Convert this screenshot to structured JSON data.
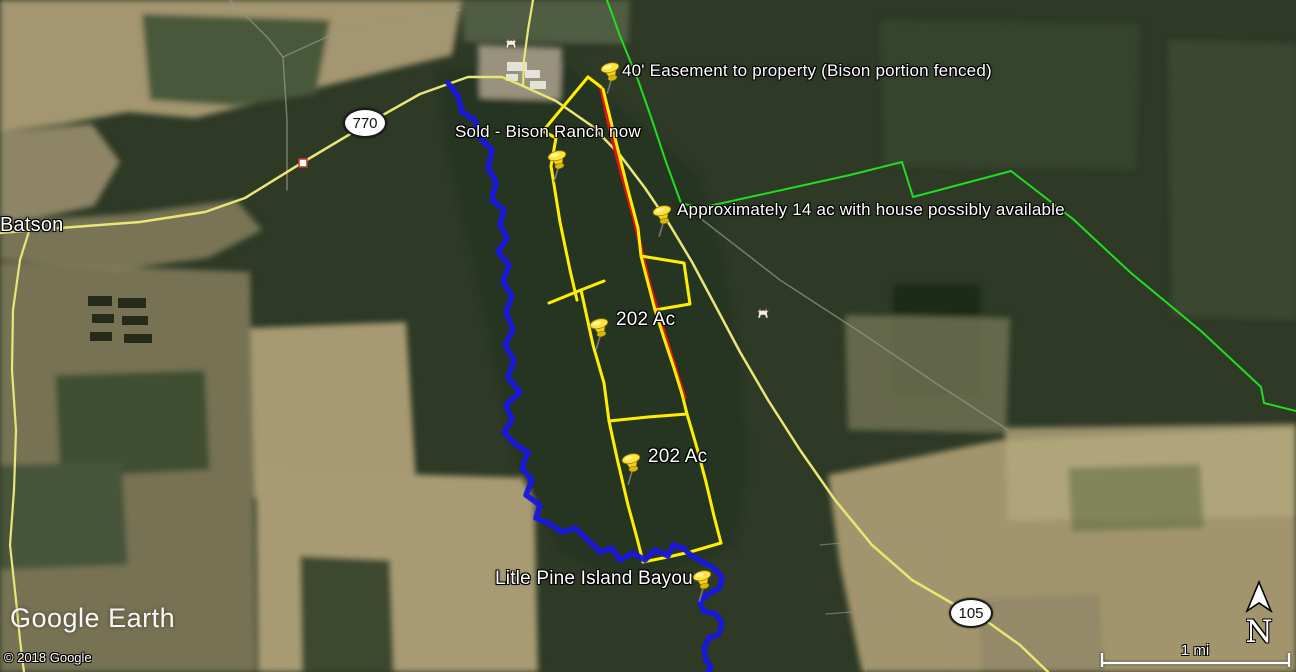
{
  "app": {
    "brand": "Google Earth",
    "copyright": "© 2018 Google",
    "scale_label": "1 mi",
    "compass_label": "N"
  },
  "colors": {
    "property_boundary": "#ffee00",
    "easement": "#e11212",
    "survey_boundary": "#21dd21",
    "bayou": "#1717e0",
    "road": "#e9e678",
    "minor_road": "#949a82",
    "label_text": "#ffffff",
    "shield_bg": "#fdfdfd"
  },
  "placemarks": [
    {
      "id": "batson-town",
      "label": "Batson",
      "label_pos": {
        "x": 0,
        "y": 214
      },
      "size": 20
    },
    {
      "id": "easement",
      "label": "40' Easement to property (Bison portion fenced)",
      "pin": {
        "x": 603,
        "y": 92
      },
      "label_pos": {
        "x": 622,
        "y": 62
      },
      "size": 17
    },
    {
      "id": "sold-bison-ranch",
      "label": "Sold - Bison Ranch now",
      "pin": {
        "x": 550,
        "y": 180
      },
      "label_pos": {
        "x": 455,
        "y": 123
      },
      "size": 17
    },
    {
      "id": "approx-14ac",
      "label": "Approximately 14 ac with house possibly available",
      "pin": {
        "x": 655,
        "y": 235
      },
      "label_pos": {
        "x": 677,
        "y": 201
      },
      "size": 17
    },
    {
      "id": "202ac-north",
      "label": "202 Ac",
      "pin": {
        "x": 592,
        "y": 348
      },
      "label_pos": {
        "x": 616,
        "y": 310
      },
      "size": 19
    },
    {
      "id": "202ac-south",
      "label": "202 Ac",
      "pin": {
        "x": 624,
        "y": 483
      },
      "label_pos": {
        "x": 648,
        "y": 447
      },
      "size": 19
    },
    {
      "id": "bayou-placemark",
      "label": "Litle Pine Island Bayou",
      "pin": {
        "x": 695,
        "y": 600
      },
      "label_pos": {
        "x": 495,
        "y": 569
      },
      "size": 19
    }
  ],
  "road_shields": [
    {
      "text": "770",
      "x": 365,
      "y": 123
    },
    {
      "text": "105",
      "x": 971,
      "y": 613
    }
  ],
  "poi_icons": [
    {
      "type": "animal",
      "x": 511,
      "y": 42
    },
    {
      "type": "animal",
      "x": 763,
      "y": 312
    },
    {
      "type": "box",
      "x": 305,
      "y": 163
    }
  ],
  "map_features": {
    "terrain": [
      {
        "fill": "#a39670",
        "pts": "0,0 462,0 452,55 390,70 325,86 260,102 195,118 128,112 64,124 0,132"
      },
      {
        "fill": "#49593a",
        "pts": "142,14 330,20 316,94 236,106 150,100"
      },
      {
        "fill": "#8d8566",
        "pts": "0,132 92,124 120,162 94,206 38,218 0,222"
      },
      {
        "fill": "#857f5e",
        "pts": "0,222 128,214 236,200 262,230 208,258 118,270 0,260",
        "opacity": 0.85
      },
      {
        "fill": "#a79a72",
        "pts": "250,328 406,322 416,482 348,502 254,498"
      },
      {
        "fill": "#8a8160",
        "pts": "0,262 250,272 256,672 0,672",
        "opacity": 0.8
      },
      {
        "fill": "#415033",
        "pts": "55,375 205,370 210,470 60,478"
      },
      {
        "fill": "#46543a",
        "pts": "0,465 122,462 128,565 0,570"
      },
      {
        "fill": "#a89b73",
        "pts": "256,470 534,478 538,672 258,672"
      },
      {
        "fill": "#3c4a2f",
        "pts": "300,556 390,560 394,672 302,672"
      },
      {
        "fill": "#263420",
        "pts": "438,72 560,60 640,122 700,176 724,260 740,360 748,470 734,546 688,566 624,582 558,552 518,470 494,360 468,240 448,152"
      },
      {
        "fill": "#1e2a17",
        "pts": "893,285 981,285 981,397 893,397"
      },
      {
        "fill": "#3a4830",
        "pts": "880,20 1140,24 1136,170 884,166",
        "opacity": 0.65
      },
      {
        "fill": "#415035",
        "pts": "1168,40 1296,44 1296,320 1172,316",
        "opacity": 0.65
      },
      {
        "fill": "#6e7152",
        "pts": "845,315 1010,318 1006,433 848,430",
        "opacity": 0.85
      },
      {
        "fill": "#a2956d",
        "pts": "828,475 1000,440 1296,428 1296,672 862,672 840,565"
      },
      {
        "fill": "#b4a77d",
        "pts": "1005,428 1296,424 1296,516 1008,520",
        "opacity": 0.8
      },
      {
        "fill": "#5d6b44",
        "pts": "1068,468 1200,464 1204,528 1072,532",
        "opacity": 0.55
      },
      {
        "fill": "#8f8465",
        "pts": "978,598 1100,594 1104,672 982,672",
        "opacity": 0.7
      },
      {
        "fill": "#99937d",
        "pts": "478,45 562,48 560,100 480,98"
      },
      {
        "fill": "#5c684c",
        "pts": "462,0 630,0 628,44 464,42",
        "opacity": 0.75
      }
    ],
    "tree_rows": [
      [
        88,
        296,
        24,
        10
      ],
      [
        118,
        298,
        28,
        10
      ],
      [
        92,
        314,
        22,
        9
      ],
      [
        122,
        316,
        26,
        9
      ],
      [
        90,
        332,
        22,
        9
      ],
      [
        124,
        334,
        28,
        9
      ]
    ],
    "buildings": [
      [
        507,
        62,
        20,
        9
      ],
      [
        525,
        70,
        15,
        8
      ],
      [
        506,
        74,
        12,
        7
      ],
      [
        530,
        81,
        16,
        8
      ]
    ],
    "lines": [
      {
        "name": "minor-road",
        "stroke": "minor_road",
        "w": 1.5,
        "opacity": 0.7,
        "pts": "230,0 268,38 283,57 287,120 287,190"
      },
      {
        "name": "minor-road",
        "stroke": "minor_road",
        "w": 1.5,
        "opacity": 0.7,
        "pts": "283,57 340,31 420,15 460,10"
      },
      {
        "name": "minor-road",
        "stroke": "minor_road",
        "w": 1.5,
        "opacity": 0.7,
        "pts": "700,218 780,280 860,332 940,386 1008,430"
      },
      {
        "name": "field-track",
        "stroke": "minor_road",
        "w": 1.2,
        "opacity": 0.6,
        "pts": "858,478 866,672"
      },
      {
        "name": "field-track",
        "stroke": "minor_road",
        "w": 1.2,
        "opacity": 0.6,
        "pts": "820,545 955,532"
      },
      {
        "name": "field-track",
        "stroke": "minor_road",
        "w": 1.2,
        "opacity": 0.6,
        "pts": "826,614 1004,600"
      },
      {
        "name": "field-track",
        "stroke": "minor_road",
        "w": 1.2,
        "opacity": 0.6,
        "pts": "938,524 948,668"
      },
      {
        "name": "road-left",
        "stroke": "road",
        "w": 2.2,
        "pts": "30,228 20,260 13,310 12,370 16,430 14,490 10,545 16,600 20,640 24,672"
      },
      {
        "name": "road-770",
        "stroke": "road",
        "w": 2.5,
        "pts": "0,233 60,228 140,222 205,212 245,198 300,164 367,124 420,94 468,77 502,77 523,86"
      },
      {
        "name": "road-105",
        "stroke": "road",
        "w": 2.5,
        "pts": "523,86 556,101 592,126 620,155 645,188 668,222 692,262 715,305 740,352 768,400 800,450 835,500 872,545 912,580 950,602 985,620 1020,645 1048,672"
      },
      {
        "name": "road-north-stub",
        "stroke": "road",
        "w": 2.2,
        "pts": "533,0 528,30 524,60 523,86"
      },
      {
        "name": "green-boundary",
        "stroke": "survey_boundary",
        "w": 2,
        "pts": "607,0 620,36 638,80 652,120 666,162 681,203 700,208 850,175 902,162 913,197 1011,171 1073,219 1131,273 1201,331 1261,387 1264,403 1296,411"
      },
      {
        "name": "easement-line",
        "stroke": "easement",
        "w": 3.5,
        "pts": "601,88 610,130 621,172 633,215 641,248 649,282 656,306 664,332 671,354 678,377 685,398"
      },
      {
        "name": "parcel-west-north",
        "stroke": "property_boundary",
        "w": 3,
        "pts": "588,77 543,131 556,138 551,166 560,222 570,270 577,300"
      },
      {
        "name": "parcel-apex",
        "stroke": "property_boundary",
        "w": 3,
        "pts": "588,77 601,87"
      },
      {
        "name": "parcel-east-north",
        "stroke": "property_boundary",
        "w": 3,
        "pts": "603,89 615,138 628,190 638,228 641,256"
      },
      {
        "name": "parcel-notch",
        "stroke": "property_boundary",
        "w": 3,
        "pts": "641,256 684,263 690,304 655,310 641,256"
      },
      {
        "name": "parcel-division-1",
        "stroke": "property_boundary",
        "w": 3,
        "pts": "549,303 581,290 604,281"
      },
      {
        "name": "parcel-west-mid",
        "stroke": "property_boundary",
        "w": 3,
        "pts": "581,290 593,345 604,383 609,421"
      },
      {
        "name": "parcel-east-mid",
        "stroke": "property_boundary",
        "w": 3,
        "pts": "655,310 664,338 674,368 682,394 687,414"
      },
      {
        "name": "parcel-division-2",
        "stroke": "property_boundary",
        "w": 3,
        "pts": "609,421 648,417 687,414"
      },
      {
        "name": "parcel-west-south",
        "stroke": "property_boundary",
        "w": 3,
        "pts": "609,421 617,458 628,505 637,538 643,562"
      },
      {
        "name": "parcel-east-south",
        "stroke": "property_boundary",
        "w": 3,
        "pts": "687,414 697,448 706,482 714,516 721,543"
      },
      {
        "name": "parcel-bottom",
        "stroke": "property_boundary",
        "w": 3,
        "pts": "643,562 668,557 690,552 721,543"
      },
      {
        "name": "bayou-line",
        "stroke": "bayou",
        "w": 5.5,
        "opacity": 0.95,
        "pts": "448,83 458,96 462,112 475,120 480,138 492,150 488,168 496,182 492,200 504,210 500,225 507,238 498,252 509,265 503,282 512,296 506,312 513,330 505,345 514,360 508,378 520,392 506,405 512,420 504,432 516,445 528,452 522,468 532,480 526,495 540,505 536,518 550,524 562,532 575,528 588,540 600,552 612,548 620,560 633,553 645,560 655,550 668,556 673,545 683,548 692,556 703,562 714,568 722,577 720,588 708,594 700,601 703,611 716,614 722,623 719,634 709,638 704,648 706,660 711,668 708,672"
      }
    ]
  }
}
